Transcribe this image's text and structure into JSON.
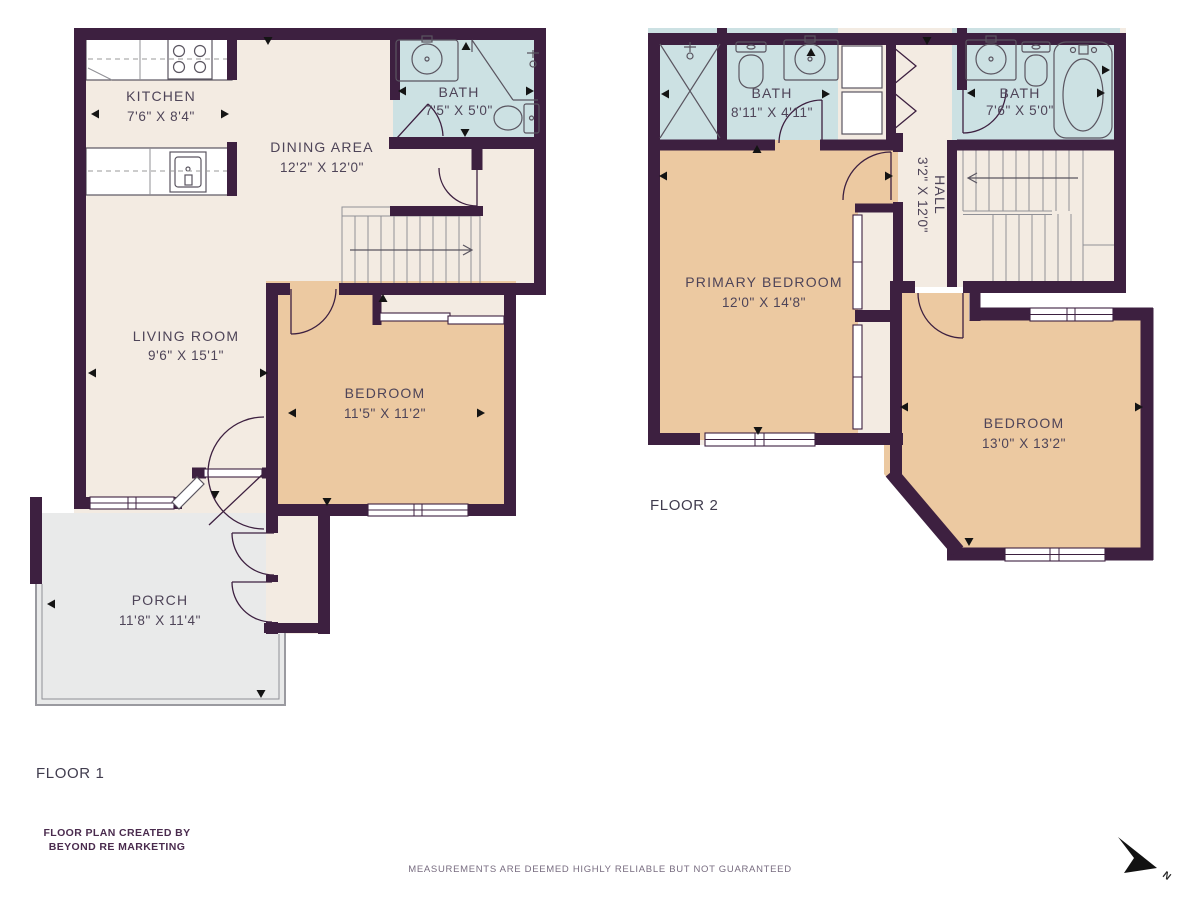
{
  "floor1": {
    "label": "FLOOR 1",
    "rooms": {
      "kitchen": {
        "name": "KITCHEN",
        "dims": "7'6\" X 8'4\""
      },
      "dining": {
        "name": "DINING AREA",
        "dims": "12'2\" X 12'0\""
      },
      "bath": {
        "name": "BATH",
        "dims": "7'5\" X 5'0\""
      },
      "living": {
        "name": "LIVING ROOM",
        "dims": "9'6\" X 15'1\""
      },
      "bedroom": {
        "name": "BEDROOM",
        "dims": "11'5\" X 11'2\""
      },
      "porch": {
        "name": "PORCH",
        "dims": "11'8\" X 11'4\""
      }
    }
  },
  "floor2": {
    "label": "FLOOR 2",
    "rooms": {
      "bath_left": {
        "name": "BATH",
        "dims": "8'11\" X 4'11\""
      },
      "bath_right": {
        "name": "BATH",
        "dims": "7'6\" X 5'0\""
      },
      "hall": {
        "name": "HALL",
        "dims": "3'2\" X 12'0\""
      },
      "primary_bedroom": {
        "name": "PRIMARY BEDROOM",
        "dims": "12'0\" X 14'8\""
      },
      "bedroom": {
        "name": "BEDROOM",
        "dims": "13'0\" X 13'2\""
      }
    }
  },
  "footer": {
    "credit_line1": "FLOOR PLAN CREATED BY",
    "credit_line2": "BEYOND RE MARKETING",
    "disclaimer": "MEASUREMENTS ARE DEEMED HIGHLY RELIABLE BUT NOT GUARANTEED"
  },
  "compass": {
    "north_label": "N"
  },
  "colors": {
    "wall": "#3D2040",
    "floor": "#F3EBE2",
    "bedroom_fill": "#ECC9A1",
    "bath_fill": "#CCE1E3",
    "porch_fill": "#E9EAEA",
    "label_text": "#4E4458",
    "credit_text": "#4A2B4E"
  }
}
